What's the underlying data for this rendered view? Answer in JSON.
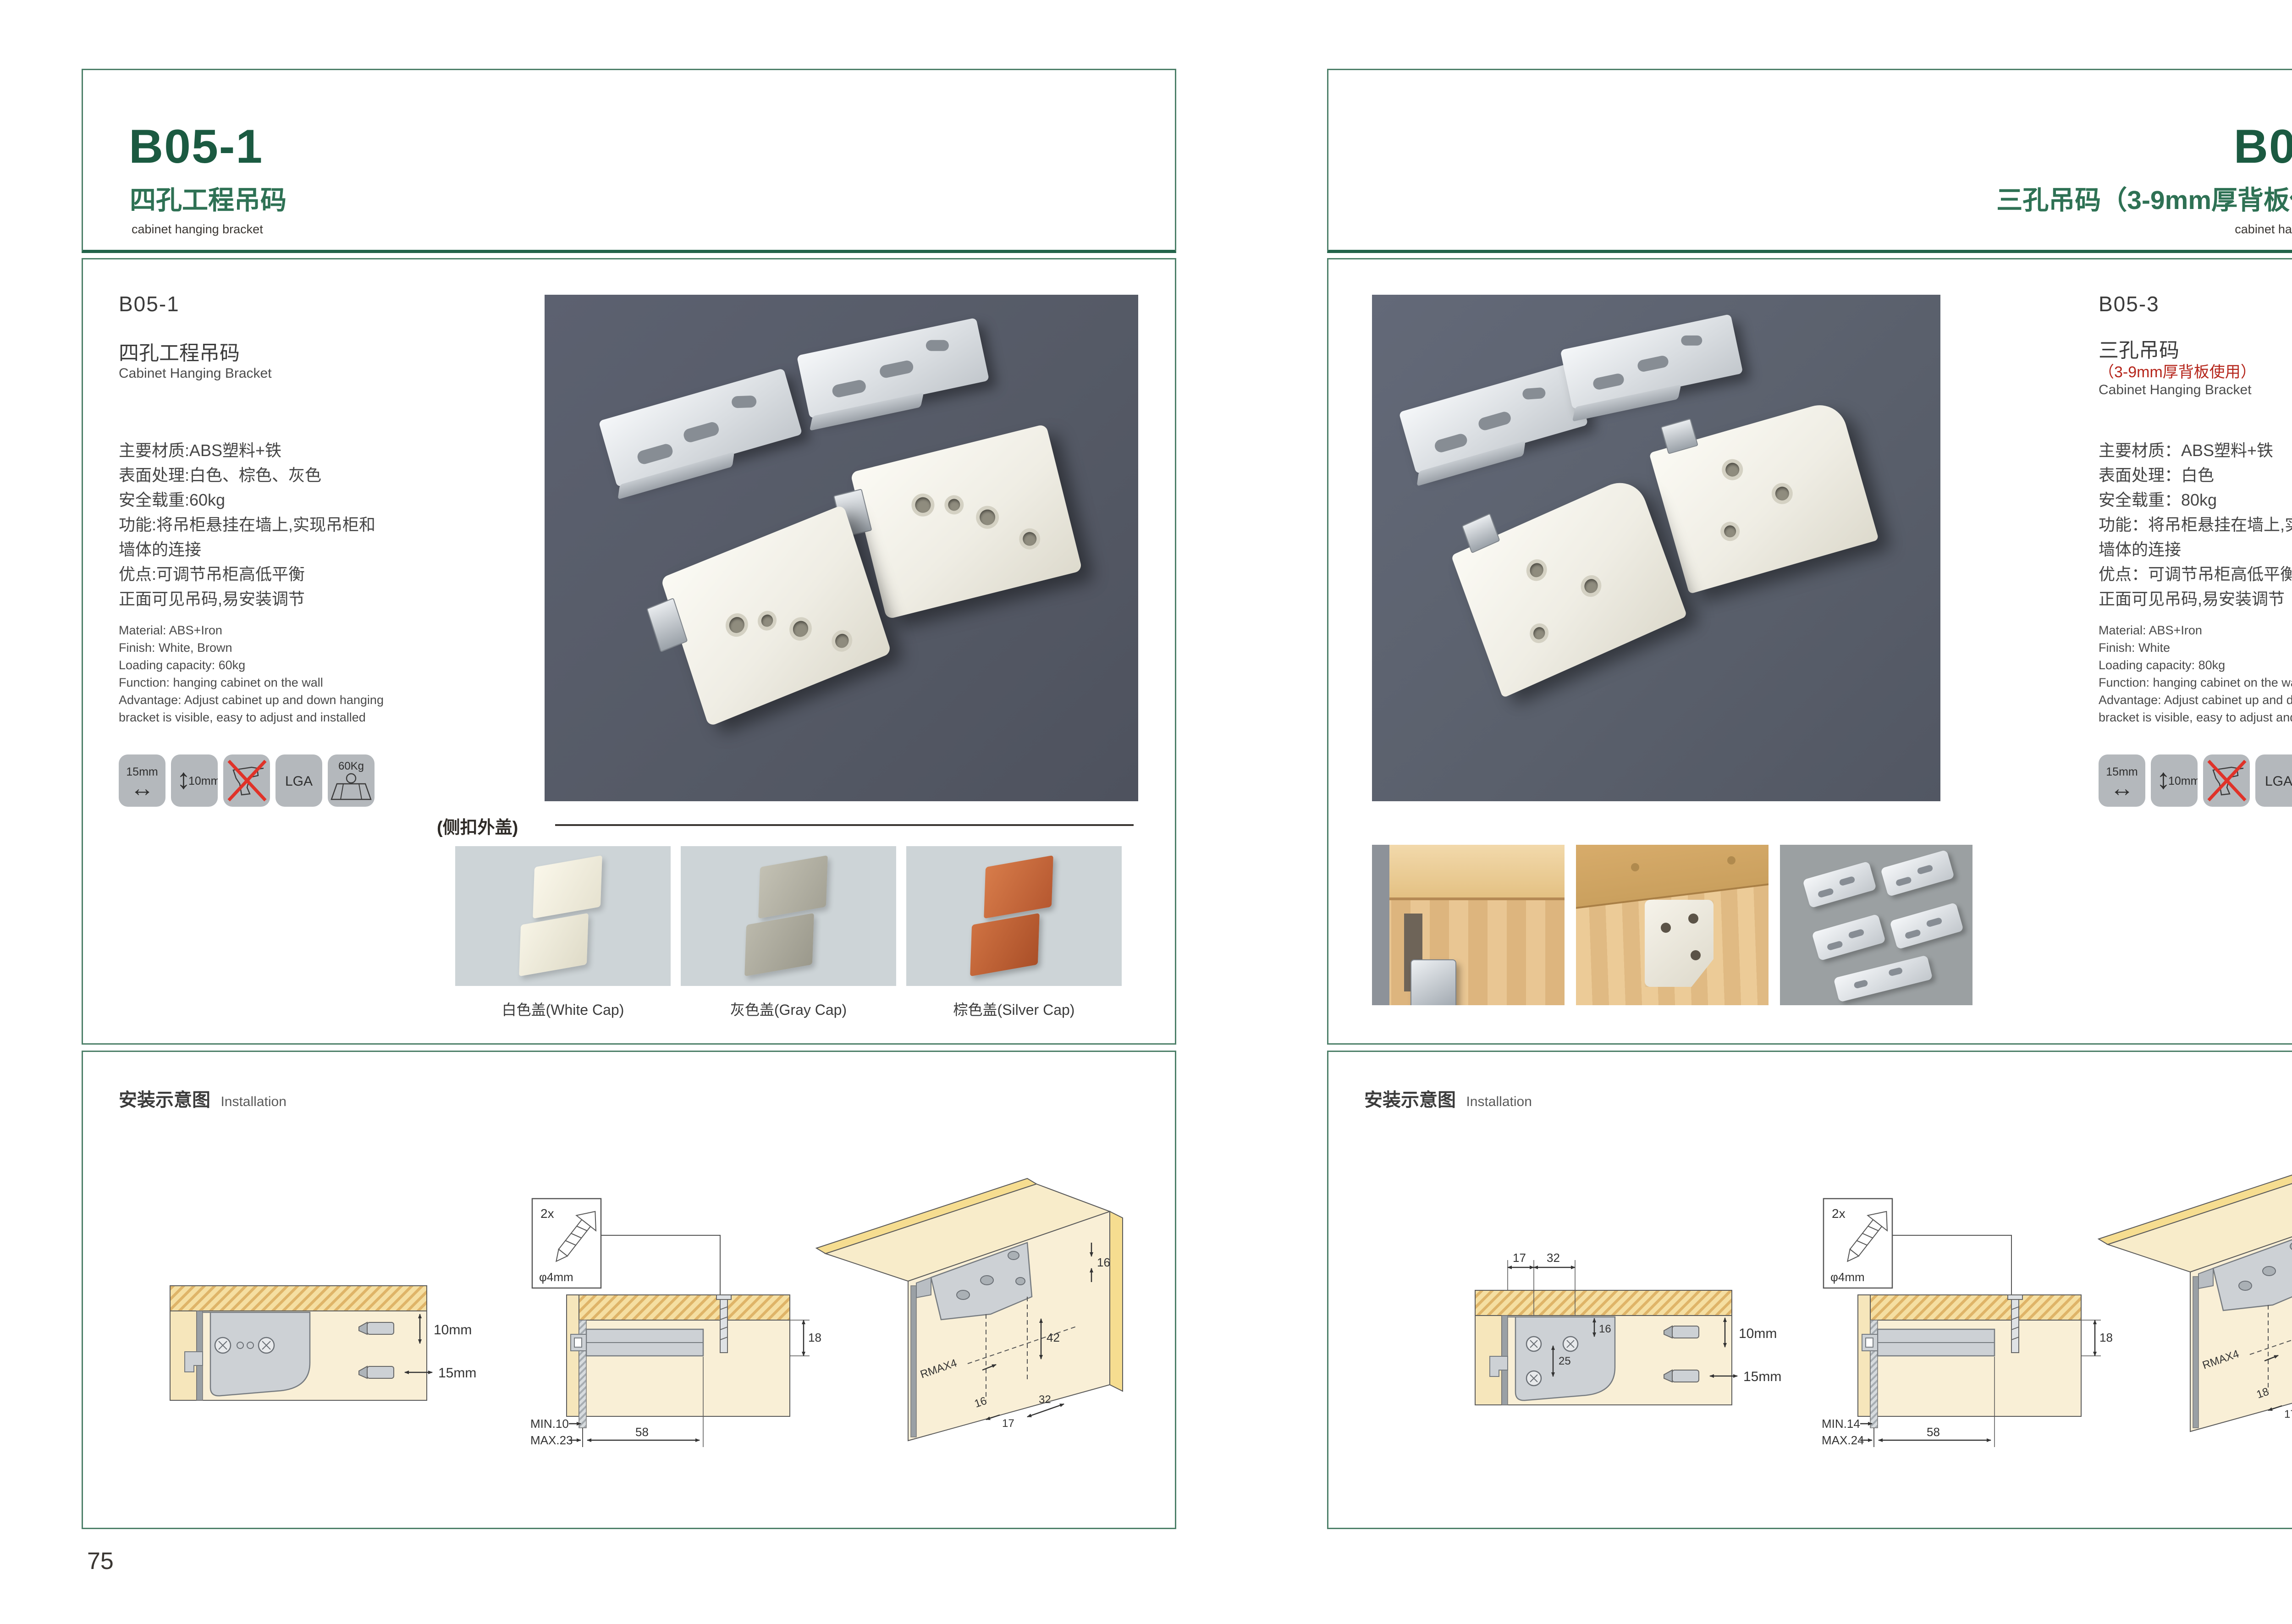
{
  "left": {
    "page_no": "75",
    "header": {
      "code": "B05-1",
      "title_cn": "四孔工程吊码",
      "title_en": "cabinet hanging bracket"
    },
    "product": {
      "code": "B05-1",
      "name_cn": "四孔工程吊码",
      "name_en": "Cabinet Hanging Bracket",
      "specs_cn": [
        "主要材质:ABS塑料+铁",
        "表面处理:白色、棕色、灰色",
        "安全载重:60kg",
        "功能:将吊柜悬挂在墙上,实现吊柜和",
        "墙体的连接",
        "优点:可调节吊柜高低平衡",
        "正面可见吊码,易安装调节"
      ],
      "specs_en": [
        "Material: ABS+Iron",
        "Finish: White, Brown",
        "Loading capacity: 60kg",
        "Function: hanging cabinet on the wall",
        "Advantage: Adjust cabinet up and down hanging",
        "bracket is visible, easy to adjust and installed"
      ]
    },
    "icons": {
      "w": "15mm",
      "h": "10mm",
      "lga": "LGA",
      "load": "60Kg"
    },
    "caps": {
      "label": "(侧扣外盖)",
      "items": [
        {
          "label": "白色盖(White Cap)"
        },
        {
          "label": "灰色盖(Gray Cap)"
        },
        {
          "label": "棕色盖(Silver Cap)"
        }
      ]
    },
    "install": {
      "title_cn": "安装示意图",
      "title_en": "Installation",
      "d1": {
        "v": "10mm",
        "h": "15mm"
      },
      "d2": {
        "qty": "2x",
        "dia": "φ4mm",
        "min": "MIN.10",
        "max": "MAX.23",
        "len": "58",
        "back": "18"
      },
      "d3": {
        "t16": "16",
        "t42": "42",
        "rmax": "RMAX4",
        "toff": "16",
        "t17": "17",
        "t32": "32"
      }
    }
  },
  "right": {
    "page_no": "76",
    "header": {
      "code": "B05-3",
      "title_cn": "三孔吊码（3-9mm厚背板使用）",
      "title_en": "cabinet hanging bracket"
    },
    "product": {
      "code": "B05-3",
      "name_cn": "三孔吊码",
      "note": "（3-9mm厚背板使用）",
      "name_en": "Cabinet Hanging Bracket",
      "specs_cn": [
        "主要材质：ABS塑料+铁",
        "表面处理：白色",
        "安全载重：80kg",
        "功能：将吊柜悬挂在墙上,实现吊柜和",
        "墙体的连接",
        "优点：可调节吊柜高低平衡",
        "正面可见吊码,易安装调节"
      ],
      "specs_en": [
        "Material: ABS+Iron",
        "Finish: White",
        "Loading capacity: 80kg",
        "Function: hanging cabinet on the wall",
        "Advantage: Adjust cabinet up and down hanging",
        "bracket is visible, easy to adjust and installed"
      ]
    },
    "icons": {
      "w": "15mm",
      "h": "10mm",
      "lga": "LGA",
      "load": "80Kg"
    },
    "install": {
      "title_cn": "安装示意图",
      "title_en": "Installation",
      "d1": {
        "t17": "17",
        "t32": "32",
        "s16": "16",
        "s25": "25",
        "v": "10mm",
        "h": "15mm"
      },
      "d2": {
        "qty": "2x",
        "dia": "φ4mm",
        "min": "MIN.14",
        "max": "MAX.24",
        "len": "58",
        "back": "18"
      },
      "d3": {
        "t16": "16",
        "t42": "42",
        "rmax": "RMAX4",
        "toff": "18",
        "t17": "17",
        "t32": "32"
      }
    }
  }
}
